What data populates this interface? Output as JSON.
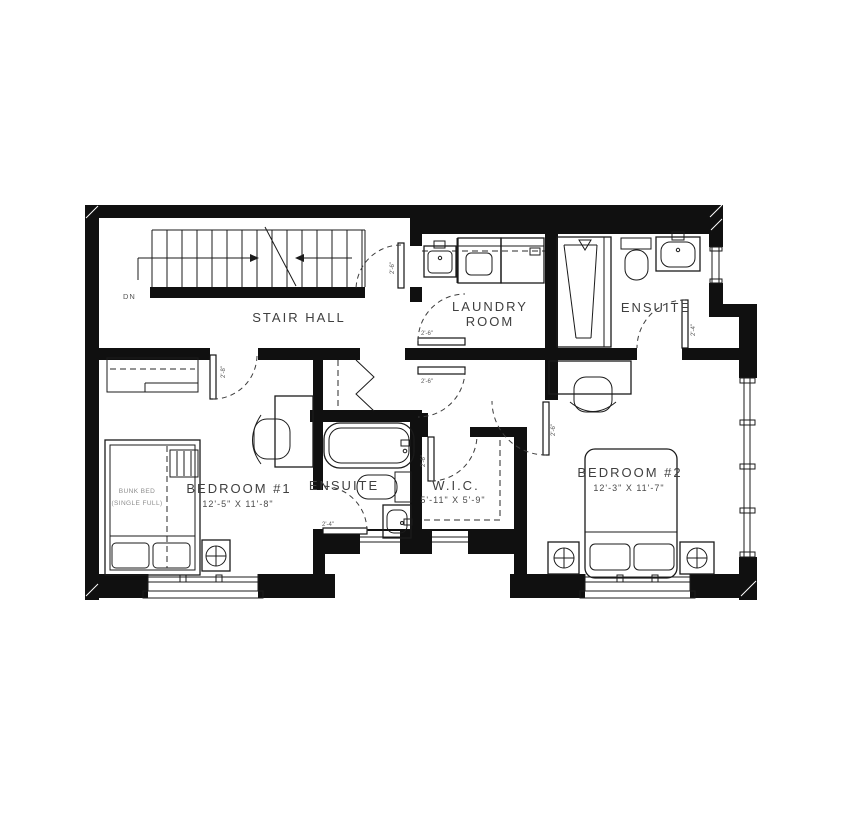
{
  "drawing": {
    "type": "residential floor plan - second storey",
    "paper_color": "#ffffff",
    "wall_color": "#101010",
    "label_color": "#3f3f3f"
  },
  "rooms": {
    "stair_hall": {
      "label": "STAIR HALL"
    },
    "laundry": {
      "label_line1": "LAUNDRY",
      "label_line2": "ROOM"
    },
    "ensuite_top": {
      "label": "ENSUITE"
    },
    "bedroom1": {
      "label": "BEDROOM #1",
      "dims": "12'-5\" X 11'-8\""
    },
    "ensuite_mid": {
      "label": "ENSUITE"
    },
    "wic": {
      "label": "W.I.C.",
      "dims": "5'-11\" X 5'-9\""
    },
    "bedroom2": {
      "label": "BEDROOM #2",
      "dims": "12'-3\" X 11'-7\""
    }
  },
  "stairs": {
    "down_label": "DN"
  },
  "furniture": {
    "bunk_bed_line1": "BUNK BED",
    "bunk_bed_line2": "(SINGLE FULL)"
  },
  "door_sizes": {
    "stair_laundry_door": "2'-6\"",
    "laundry_door": "2'-6\"",
    "hall_door": "2'-6\"",
    "wic_door": "2'-6\"",
    "bedroom2_door": "2'-6\"",
    "bedroom1_door": "2'-8\"",
    "ensuite_top_door": "2'-4\"",
    "ensuite_mid_door": "2'-4\""
  },
  "fixtures": [
    "stairs-down",
    "bathtub",
    "shower",
    "toilet",
    "vanity-sink",
    "washer",
    "dryer",
    "laundry-sink",
    "bunk-bed",
    "double-bed",
    "desk",
    "chair",
    "nightstand",
    "lamp",
    "closet",
    "bifold-door",
    "window"
  ]
}
